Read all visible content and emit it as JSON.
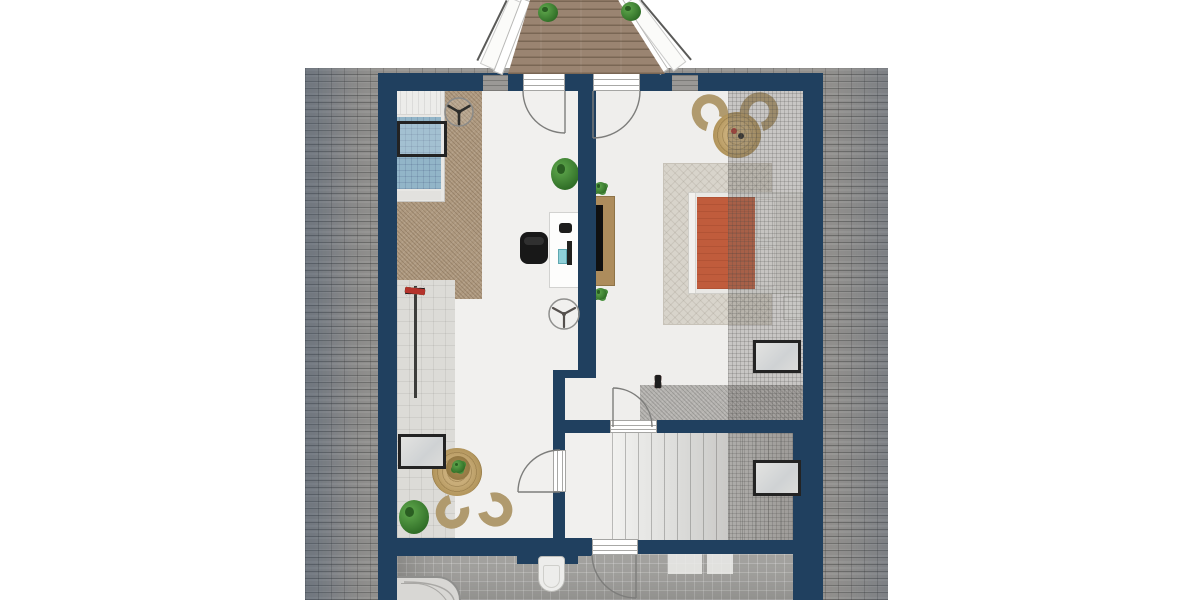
{
  "scene": {
    "kind": "architectural-floor-plan",
    "visible_text": "",
    "view": "top-down upper floor with surrounding roof and front balcony"
  },
  "colors": {
    "navy": "#20405f",
    "roofBase": "#93918e",
    "floorWhite": "#f1f0ee",
    "tileLight": "#dcdbd7",
    "tileBath": "#a5a4a1",
    "carpetTan": "#af9a80",
    "carpetGray": "#b6b4b1",
    "rugLight": "#d8d4cb",
    "jute": "#b5985f",
    "wood": "#ad8c5c",
    "deck": "#9a8471",
    "bedBlue": "#92b5c8",
    "bedOrange": "#c05c3c",
    "plantGreen": "#3f8a33",
    "frameDark": "#232323"
  },
  "balcony": {
    "plants": 2,
    "deck_material": "wood-planks",
    "doors": 2
  },
  "rooms": [
    {
      "name": "bedroom-left",
      "furniture": [
        "single-bed-blue",
        "skylight-over-bed",
        "ceiling-fan",
        "wardrobe-clothes-rack",
        "desk",
        "office-chair",
        "potted-plant",
        "ceiling-fan-2",
        "skylight-left-wall",
        "round-jute-rug",
        "two-wicker-chairs",
        "side-table-plant",
        "floor-plant"
      ]
    },
    {
      "name": "bedroom-right",
      "furniture": [
        "double-bed-orange",
        "tv-sideboard",
        "two-wicker-chairs",
        "round-jute-rug",
        "area-rug",
        "shoe-row",
        "skylight-right-wall",
        "nightstand",
        "gray-carpet-strip"
      ]
    },
    {
      "name": "stair-hall",
      "furniture": [
        "staircase",
        "skylight-right-wall"
      ]
    },
    {
      "name": "bathroom",
      "furniture": [
        "bathtub",
        "wall-hung-toilet",
        "bath-mat",
        "bath-mat-2"
      ]
    }
  ],
  "closet": {
    "items": [
      "#d8d8d6",
      "#c6c6c4",
      "#202020",
      "#b5332c",
      "#d8d8d6",
      "#2a8f84",
      "#202020",
      "#b5332c",
      "#3a9a40",
      "#d8d8d6",
      "#202020",
      "#b5332c"
    ]
  },
  "shoes": {
    "items": [
      "#1d1d1d",
      "#1d1d1d",
      "#2a7a2e",
      "#1d1d1d",
      "#b5332c",
      "#787876",
      "#1d1d1d",
      "#b5332c",
      "#3a3a38",
      "#1d1d1d"
    ]
  }
}
